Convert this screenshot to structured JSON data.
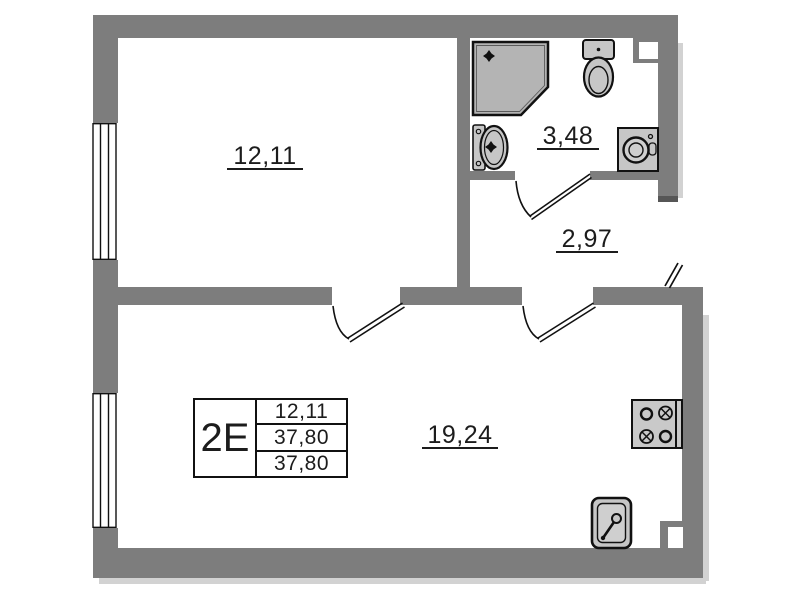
{
  "plan": {
    "unit": {
      "type_label": "2E",
      "row1": "12,11",
      "row2": "37,80",
      "row3": "37,80"
    },
    "rooms": {
      "bedroom": {
        "area": "12,11"
      },
      "bathroom": {
        "area": "3,48"
      },
      "hallway": {
        "area": "2,97"
      },
      "living": {
        "area": "19,24"
      }
    },
    "fixtures": [
      "shower",
      "toilet",
      "wash-basin",
      "washing-machine",
      "stove",
      "kitchen-sink"
    ],
    "doors": [
      "bedroom-door",
      "living-room-door",
      "bathroom-door",
      "entrance-door"
    ],
    "windows": [
      "bedroom-window",
      "living-room-window"
    ],
    "colors": {
      "wall": "#7d7d7d",
      "wall_dark": "#565656",
      "fixture": "#c6c6c6",
      "shower": "#b4b4b4",
      "line": "#111111",
      "shadow": "#d2d2d2",
      "paper": "#ffffff"
    }
  }
}
